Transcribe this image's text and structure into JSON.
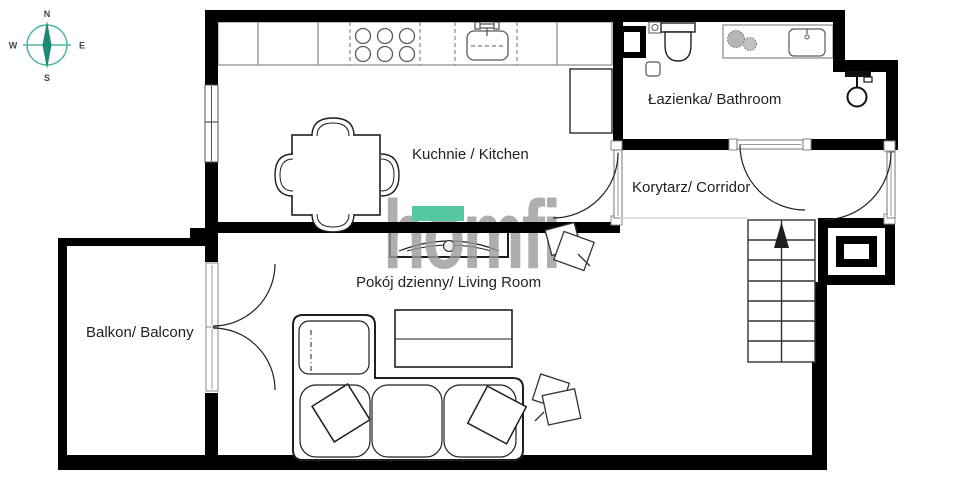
{
  "canvas": {
    "width": 974,
    "height": 486
  },
  "colors": {
    "wall": "#000000",
    "furniture_outline": "#1f1f1f",
    "counter_outline": "#8a8a8a",
    "compass_ring": "#4cb6a0",
    "compass_needle": "#1d8a78",
    "logo_gray": "#9b9b9b",
    "logo_green": "#56c89f",
    "label_text": "#1f1f1f"
  },
  "compass": {
    "north": "N",
    "east": "E",
    "south": "S",
    "west": "W"
  },
  "watermark": {
    "brand": "homfi"
  },
  "rooms": {
    "kitchen": {
      "label": "Kuchnie / Kitchen"
    },
    "bathroom": {
      "label": "Łazienka/ Bathroom"
    },
    "corridor": {
      "label": "Korytarz/ Corridor"
    },
    "living_room": {
      "label": "Pokój dzienny/ Living Room"
    },
    "balcony": {
      "label": "Balkon/ Balcony"
    }
  }
}
